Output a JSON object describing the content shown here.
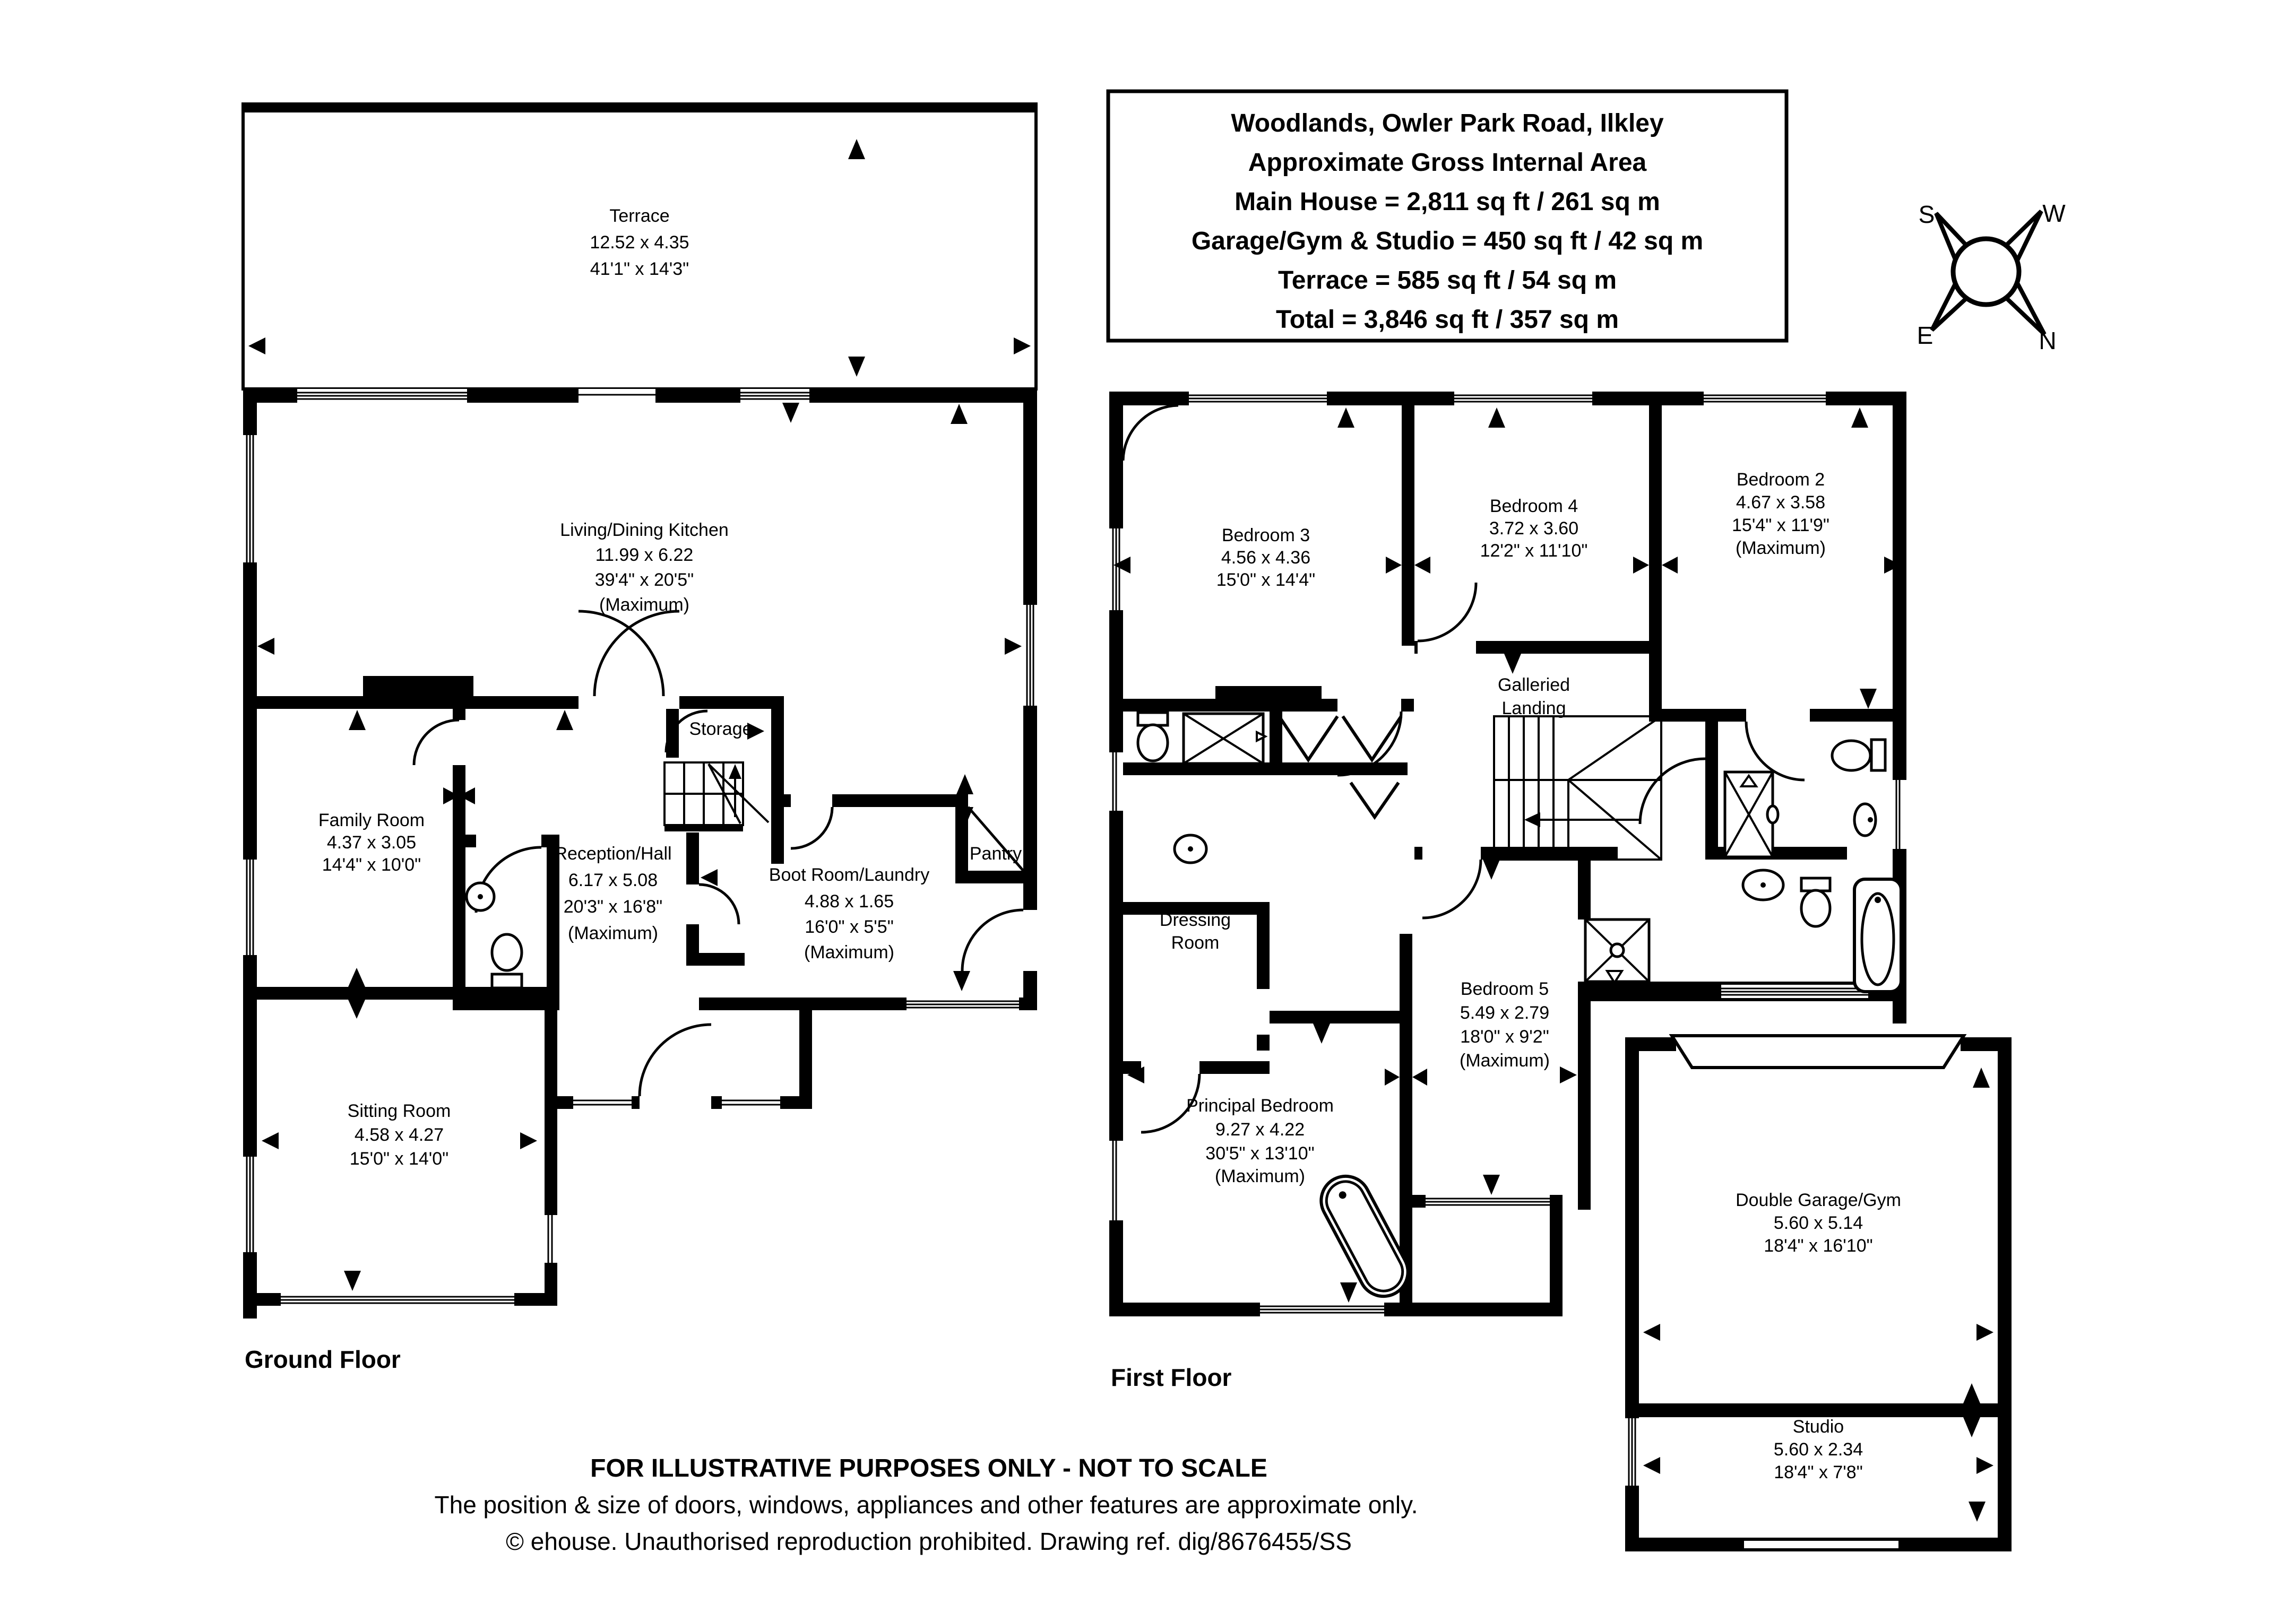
{
  "document": {
    "type": "floor-plan",
    "colors": {
      "ink": "#000000",
      "background": "#ffffff"
    }
  },
  "title_box": {
    "lines": [
      "Woodlands, Owler Park Road, Ilkley",
      "Approximate Gross Internal Area",
      "Main House = 2,811 sq ft / 261 sq m",
      "Garage/Gym & Studio = 450 sq ft / 42 sq m",
      "Terrace = 585 sq ft / 54 sq m",
      "Total = 3,846 sq ft / 357 sq m"
    ]
  },
  "compass": {
    "south": "S",
    "west": "W",
    "east": "E",
    "north": "N"
  },
  "ground_floor": {
    "label": "Ground Floor",
    "rooms": {
      "terrace": {
        "name": "Terrace",
        "dims_m": "12.52 x 4.35",
        "dims_ft": "41'1\" x 14'3\""
      },
      "kitchen": {
        "name": "Living/Dining Kitchen",
        "dims_m": "11.99 x 6.22",
        "dims_ft": "39'4\" x 20'5\"",
        "qualifier": "(Maximum)"
      },
      "family_room": {
        "name": "Family Room",
        "dims_m": "4.37 x 3.05",
        "dims_ft": "14'4\" x 10'0\""
      },
      "reception_hall": {
        "name": "Reception/Hall",
        "dims_m": "6.17 x 5.08",
        "dims_ft": "20'3\" x 16'8\"",
        "qualifier": "(Maximum)"
      },
      "storage": {
        "name": "Storage"
      },
      "boot_room": {
        "name": "Boot Room/Laundry",
        "dims_m": "4.88 x 1.65",
        "dims_ft": "16'0\" x 5'5\"",
        "qualifier": "(Maximum)"
      },
      "pantry": {
        "name": "Pantry"
      },
      "sitting_room": {
        "name": "Sitting Room",
        "dims_m": "4.58 x 4.27",
        "dims_ft": "15'0\" x 14'0\""
      }
    }
  },
  "first_floor": {
    "label": "First Floor",
    "rooms": {
      "bedroom_3": {
        "name": "Bedroom 3",
        "dims_m": "4.56 x 4.36",
        "dims_ft": "15'0\" x 14'4\""
      },
      "bedroom_4": {
        "name": "Bedroom 4",
        "dims_m": "3.72 x 3.60",
        "dims_ft": "12'2\" x 11'10\""
      },
      "bedroom_2": {
        "name": "Bedroom 2",
        "dims_m": "4.67 x 3.58",
        "dims_ft": "15'4\" x 11'9\"",
        "qualifier": "(Maximum)"
      },
      "galleried_landing": {
        "line1": "Galleried",
        "line2": "Landing"
      },
      "dressing_room": {
        "line1": "Dressing",
        "line2": "Room"
      },
      "bedroom_5": {
        "name": "Bedroom 5",
        "dims_m": "5.49 x 2.79",
        "dims_ft": "18'0\" x 9'2\"",
        "qualifier": "(Maximum)"
      },
      "principal_bedroom": {
        "name": "Principal Bedroom",
        "dims_m": "9.27 x 4.22",
        "dims_ft": "30'5\" x 13'10\"",
        "qualifier": "(Maximum)"
      }
    }
  },
  "outbuilding": {
    "garage": {
      "name": "Double Garage/Gym",
      "dims_m": "5.60 x 5.14",
      "dims_ft": "18'4\" x 16'10\""
    },
    "studio": {
      "name": "Studio",
      "dims_m": "5.60 x 2.34",
      "dims_ft": "18'4\" x 7'8\""
    }
  },
  "footer": {
    "line1": "FOR ILLUSTRATIVE PURPOSES ONLY - NOT TO SCALE",
    "line2": "The position & size of doors, windows, appliances and other features are approximate only.",
    "line3": "© ehouse. Unauthorised reproduction prohibited. Drawing ref. dig/8676455/SS"
  }
}
